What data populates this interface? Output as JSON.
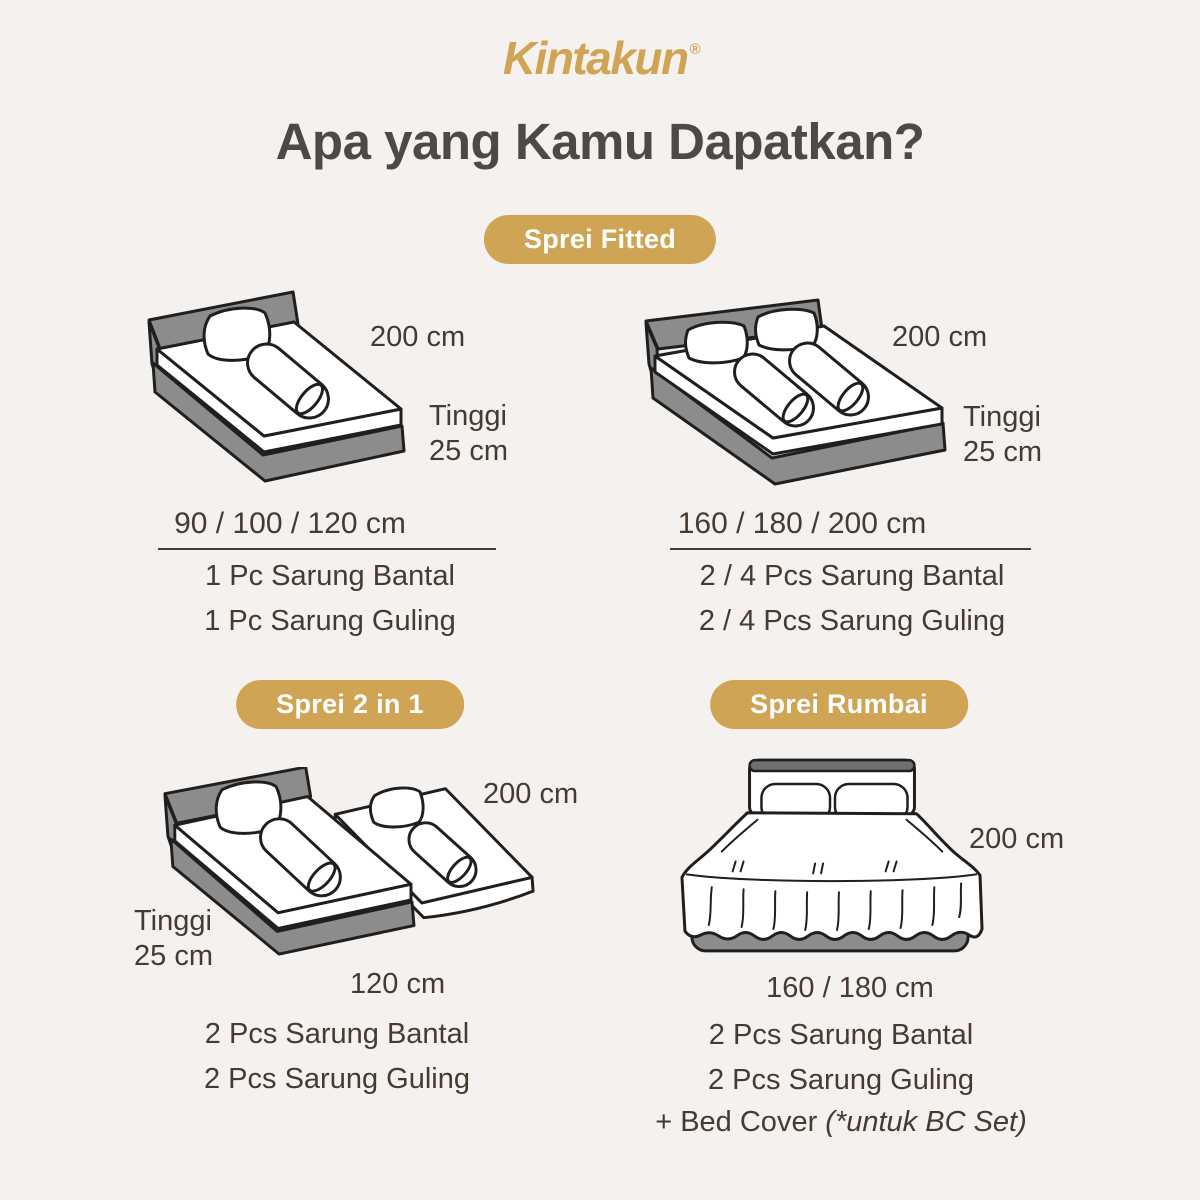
{
  "colors": {
    "background": "#F4F1EE",
    "gold": "#D0A455",
    "title_text": "#4B4A48",
    "body_text": "#473A31",
    "bed_gray": "#8C8C8C",
    "outline": "#1F1F1F"
  },
  "logo": {
    "text": "Kintakun",
    "registered": "®"
  },
  "title": "Apa yang Kamu Dapatkan?",
  "sections": {
    "fitted": {
      "badge": "Sprei Fitted",
      "single": {
        "top_label": "200 cm",
        "height_line1": "Tinggi",
        "height_line2": "25 cm",
        "sizes": "90 / 100 / 120 cm",
        "items": [
          "1 Pc Sarung Bantal",
          "1 Pc Sarung Guling"
        ]
      },
      "double": {
        "top_label": "200 cm",
        "height_line1": "Tinggi",
        "height_line2": "25 cm",
        "sizes": "160 / 180 / 200 cm",
        "items": [
          "2 / 4 Pcs Sarung Bantal",
          "2 / 4 Pcs Sarung Guling"
        ]
      }
    },
    "two_in_one": {
      "badge": "Sprei 2 in 1",
      "top_label": "200 cm",
      "height_line1": "Tinggi",
      "height_line2": "25 cm",
      "bottom_label": "120 cm",
      "items": [
        "2 Pcs Sarung Bantal",
        "2 Pcs Sarung Guling"
      ]
    },
    "rumbai": {
      "badge": "Sprei Rumbai",
      "top_label": "200 cm",
      "bottom_label": "160 / 180 cm",
      "items": [
        "2 Pcs Sarung Bantal",
        "2 Pcs Sarung Guling"
      ],
      "extra_prefix": "+ Bed Cover ",
      "extra_italic": "(*untuk BC Set)"
    }
  }
}
